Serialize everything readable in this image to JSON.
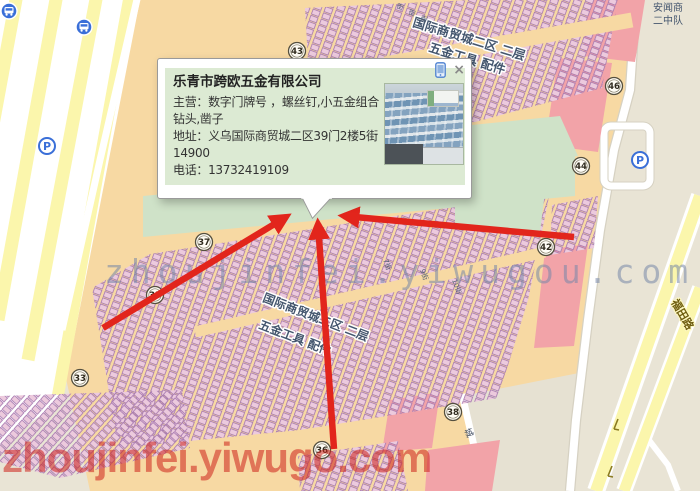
{
  "popup": {
    "title": "乐青市跨欧五金有限公司",
    "main_line": "主营：数字门牌号 ，螺丝钉,小五金组合钻头,凿子",
    "address_line": "地址：义乌国际商贸城二区39门2楼5街 14900",
    "phone_line": "电话：13732419109",
    "close_glyph": "×"
  },
  "map": {
    "area_labels": {
      "top_market": "国际商贸城二区  二层",
      "top_category": "五金工具 配件",
      "mid_market": "国际商贸城二区  二层",
      "mid_category": "五金工具 配件",
      "station_line1": "安闻商",
      "station_line2": "二中队",
      "road_right": "福田路",
      "small_city": "城"
    },
    "street_labels": [
      "街",
      "街",
      "街",
      "7街",
      "9街",
      "10街"
    ],
    "gates": [
      "43",
      "46",
      "44",
      "42",
      "37",
      "35",
      "33",
      "36",
      "38"
    ],
    "parking_label": "P"
  },
  "watermarks": {
    "center": "zhoujinfei.yiwugou.com",
    "bottom": "zhoujinfei.yiwugo.com"
  },
  "colors": {
    "arrow": "#e2251c",
    "market": "#f7d9a3",
    "stall": "#eccadd",
    "highlight": "#cfe2c8"
  }
}
